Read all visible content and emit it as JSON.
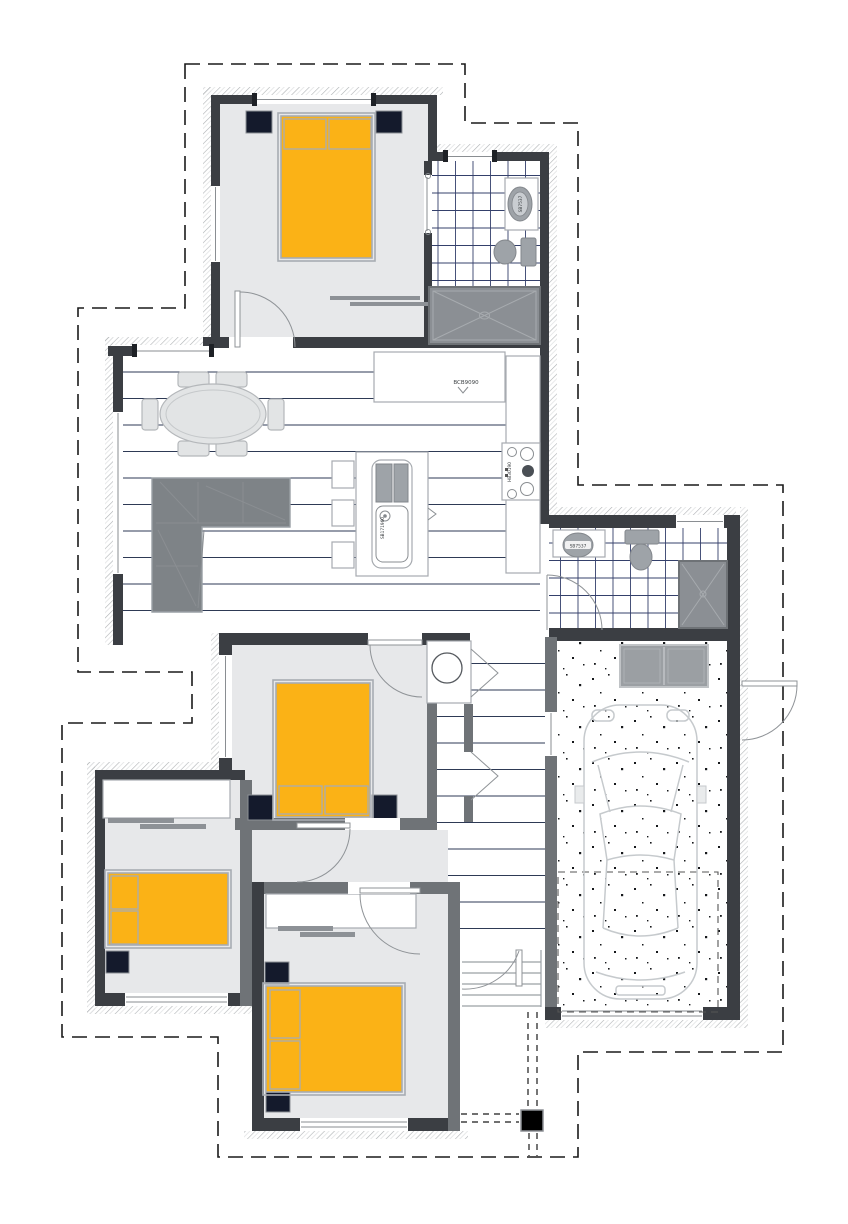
{
  "drawing": {
    "kind": "residential floor plan",
    "fixture_labels": {
      "fridge_space": "BCB9090",
      "cooktop": "HB30190",
      "island_sink": "SB171960",
      "bathroom_basin": "SB7537",
      "ensuite_basin": "SB7537"
    },
    "colors": {
      "wall": "#3B3E43",
      "interior_wall": "#6F7377",
      "room_floor": "#E7E8EA",
      "wood_line": "#2E3A55",
      "tile_line": "#34406B",
      "bed": "#FBB216",
      "bed_outline": "#A8ACB2",
      "nightstand": "#141A2C",
      "fixture": "#9EA3A8",
      "sofa": "#7E8387",
      "shower": "#8B8F94",
      "cabinet": "#9B9FA3",
      "car_outline": "#C6CACD",
      "boundary": "#1A1A1A"
    }
  }
}
